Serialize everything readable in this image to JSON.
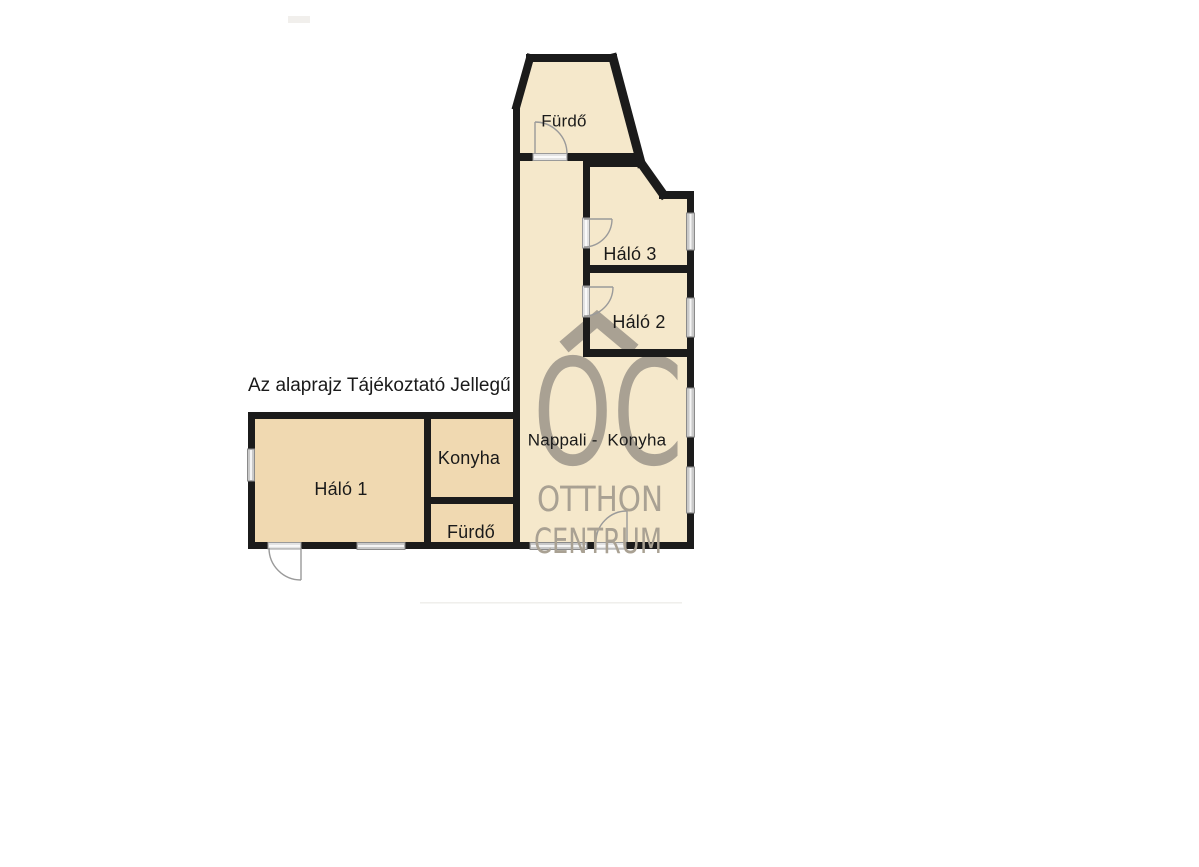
{
  "floorplan": {
    "disclaimer": "Az alaprajz Tájékoztató Jellegű",
    "rooms": [
      {
        "id": "furdo-top",
        "label": "Fürdő"
      },
      {
        "id": "halo-3",
        "label": "Háló 3"
      },
      {
        "id": "halo-2",
        "label": "Háló 2"
      },
      {
        "id": "nappali-konyha",
        "label": "Nappali -  Konyha"
      },
      {
        "id": "halo-1",
        "label": "Háló 1"
      },
      {
        "id": "konyha",
        "label": "Konyha"
      },
      {
        "id": "furdo-left",
        "label": "Fürdő"
      }
    ],
    "watermark": {
      "logo": "OC",
      "line1": "OTTHON",
      "line2": "CENTRUM"
    },
    "colors": {
      "wall": "#1b1b1b",
      "fill_main_wing": "#f5e8cb",
      "fill_left_wing": "#f0d9b1",
      "window": "#c9c9c9",
      "door_threshold": "#e3e3e3",
      "door_arc": "#9a9a9a",
      "watermark_gray": "#a9a193",
      "label_text": "#1a1a1a"
    }
  }
}
